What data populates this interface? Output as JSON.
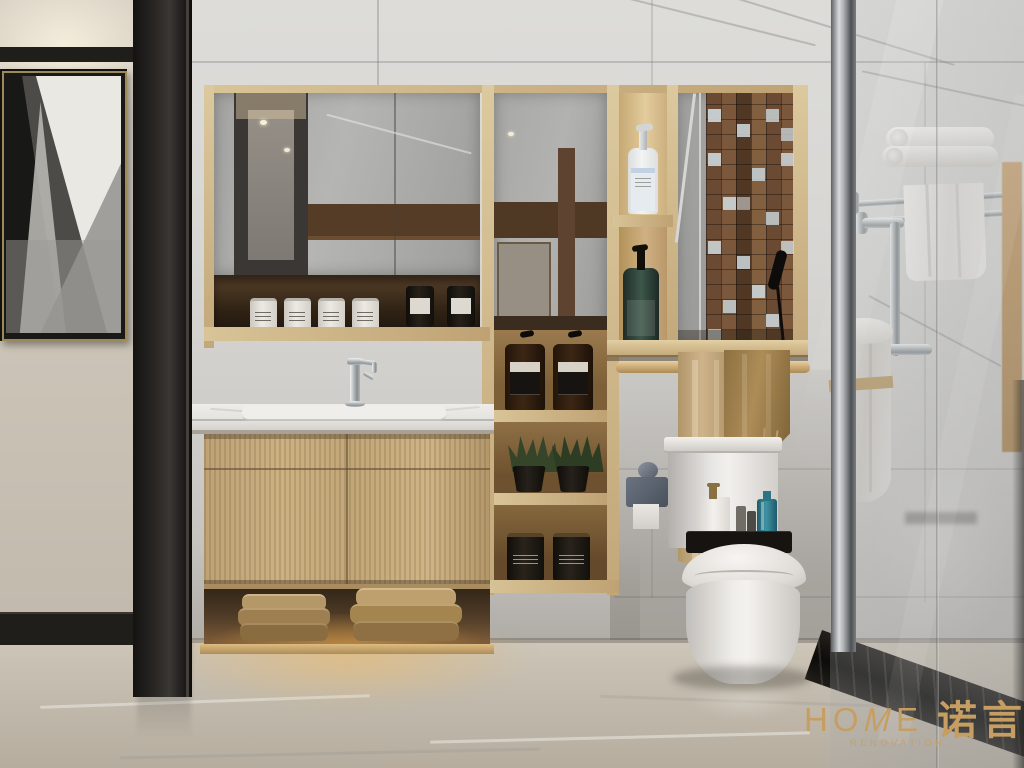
{
  "brand": {
    "word_left": "HO",
    "word_m": "M",
    "word_right": "E",
    "subtitle": "RENOVATION",
    "cjk": "诺言"
  },
  "palette": {
    "gold": "#c79e62",
    "wall_beige": "#cbc4b7",
    "marble": "#d7d6d3",
    "oak": "#c2a779",
    "oak_light": "#dcc99e",
    "walnut": "#4a3627",
    "floor_a": "#cdc6b9",
    "floor_b": "#b6ad9f",
    "black_trim": "#201e1b",
    "porcelain": "#f0eeea",
    "towel_tan": "#c0a678",
    "towel_dark": "#9a7d4d",
    "mosaic_brown": "#6b4a33",
    "mosaic_light": "#cdd6da",
    "led_glow": "#e7b96a",
    "bottle_green": "#32473d",
    "aroma_blue": "#2e7d8c"
  }
}
